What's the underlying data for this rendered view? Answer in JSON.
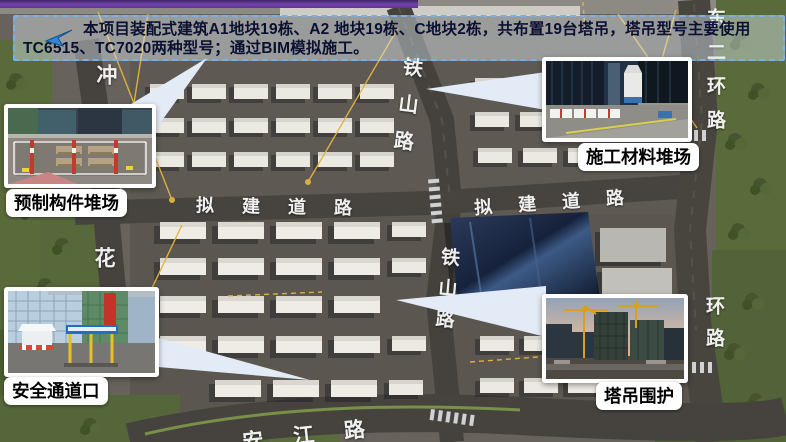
{
  "banner": {
    "line1": "本项目装配式建筑A1地块19栋、A2 地块19栋、C地块2栋，共布置19台塔吊，塔吊型号主要使用",
    "line2": "TC6515、TC7020两种型号；通过BIM模拟施工。"
  },
  "callouts": {
    "precast_yard": {
      "label": "预制构件堆场"
    },
    "material_yard": {
      "label": "施工材料堆场"
    },
    "safety_gate": {
      "label": "安全通道口"
    },
    "crane_enclosure": {
      "label": "塔吊围护"
    }
  },
  "map": {
    "road_labels": {
      "chong": "冲",
      "tieshan_upper": "铁山路",
      "tieshan_lower": "铁山路",
      "nijian_left": "拟建道路",
      "nijian_right": "拟建道路",
      "hua": "花",
      "dongerhuan_upper": "东二环路",
      "erhuan_lower": "环路",
      "jiang_road": "安江路"
    }
  },
  "colors": {
    "banner_text": "#0c1030",
    "banner_border_dash": "#7ab0e8",
    "top_bar_purple": "#7444ae",
    "arrow_blue": "#2f86d6",
    "crane_line_yellow": "#e3b33c"
  }
}
